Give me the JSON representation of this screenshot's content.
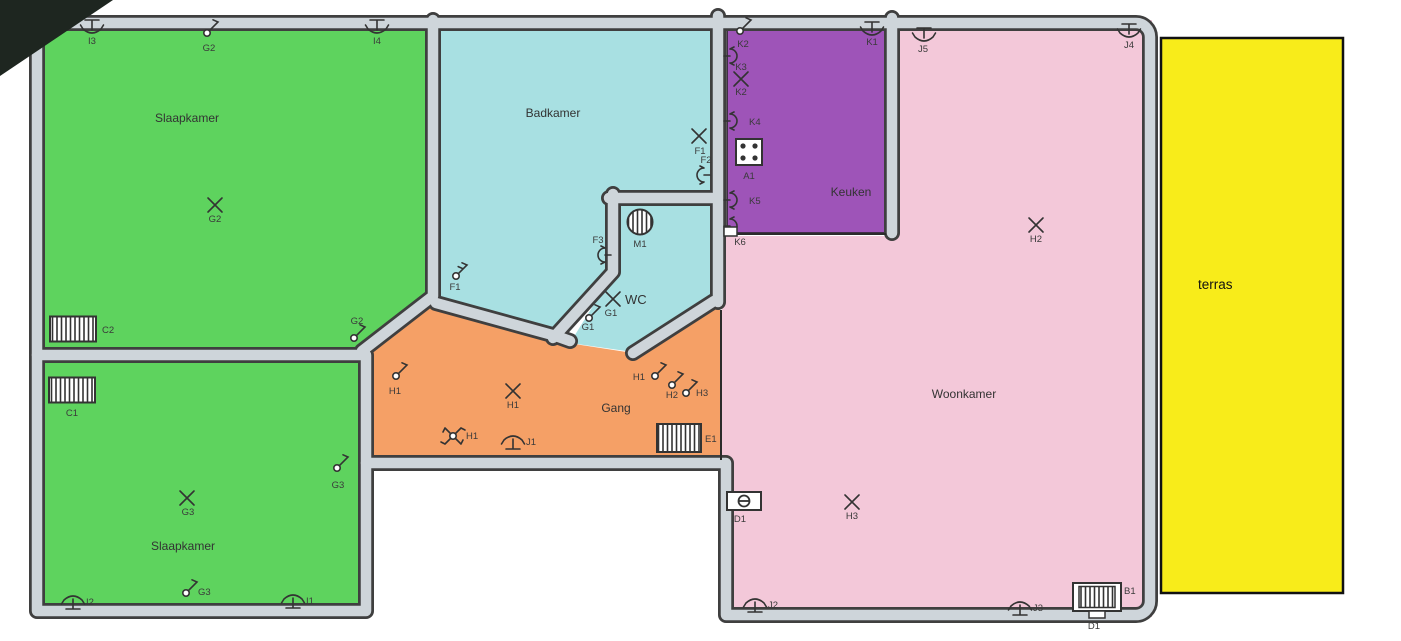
{
  "rooms": {
    "bedroom_top": "Slaapkamer",
    "bedroom_bottom": "Slaapkamer",
    "bathroom": "Badkamer",
    "wc": "WC",
    "kitchen": "Keuken",
    "living": "Woonkamer",
    "hall": "Gang",
    "terrace": "terras"
  },
  "colors": {
    "bedroom": "#5ed35e",
    "bathroom": "#a8e0e2",
    "kitchen": "#9e54b8",
    "living": "#f3c8d9",
    "hall": "#f5a066",
    "terrace": "#f8ec1a",
    "wall_fill": "#ced5da",
    "wall_edge": "#3f3f3f",
    "symbol_ink": "#333333"
  },
  "symbols": [
    {
      "label": "I3",
      "type": "wall-light"
    },
    {
      "label": "G2",
      "type": "switch"
    },
    {
      "label": "I4",
      "type": "wall-light"
    },
    {
      "label": "G2",
      "type": "ceiling-light"
    },
    {
      "label": "C2",
      "type": "radiator"
    },
    {
      "label": "G2",
      "type": "switch"
    },
    {
      "label": "C1",
      "type": "radiator"
    },
    {
      "label": "G3",
      "type": "switch"
    },
    {
      "label": "G3",
      "type": "ceiling-light"
    },
    {
      "label": "G3",
      "type": "switch"
    },
    {
      "label": "I2",
      "type": "wall-light"
    },
    {
      "label": "I1",
      "type": "wall-light"
    },
    {
      "label": "F1",
      "type": "ceiling-light"
    },
    {
      "label": "F2",
      "type": "socket"
    },
    {
      "label": "F3",
      "type": "socket"
    },
    {
      "label": "F1",
      "type": "series-switch"
    },
    {
      "label": "M1",
      "type": "ventilator"
    },
    {
      "label": "G1",
      "type": "ceiling-light"
    },
    {
      "label": "G1",
      "type": "switch"
    },
    {
      "label": "K2",
      "type": "switch"
    },
    {
      "label": "K3",
      "type": "socket"
    },
    {
      "label": "K2",
      "type": "ceiling-light"
    },
    {
      "label": "K1",
      "type": "wall-light"
    },
    {
      "label": "K4",
      "type": "socket"
    },
    {
      "label": "A1",
      "type": "stove-connection"
    },
    {
      "label": "K5",
      "type": "socket"
    },
    {
      "label": "K6",
      "type": "socket-box"
    },
    {
      "label": "J5",
      "type": "wall-light"
    },
    {
      "label": "J4",
      "type": "wall-light"
    },
    {
      "label": "H2",
      "type": "ceiling-light"
    },
    {
      "label": "H1",
      "type": "switch"
    },
    {
      "label": "H1",
      "type": "ceiling-light"
    },
    {
      "label": "H1",
      "type": "ceiling-light-pull"
    },
    {
      "label": "J1",
      "type": "wall-light"
    },
    {
      "label": "H1",
      "type": "switch"
    },
    {
      "label": "H2",
      "type": "switch"
    },
    {
      "label": "H3",
      "type": "switch"
    },
    {
      "label": "E1",
      "type": "radiator"
    },
    {
      "label": "D1",
      "type": "thermostat"
    },
    {
      "label": "H3",
      "type": "ceiling-light"
    },
    {
      "label": "J2",
      "type": "wall-light"
    },
    {
      "label": "J3",
      "type": "wall-light"
    },
    {
      "label": "B1",
      "type": "boiler"
    },
    {
      "label": "D1",
      "type": "connection-label"
    }
  ]
}
